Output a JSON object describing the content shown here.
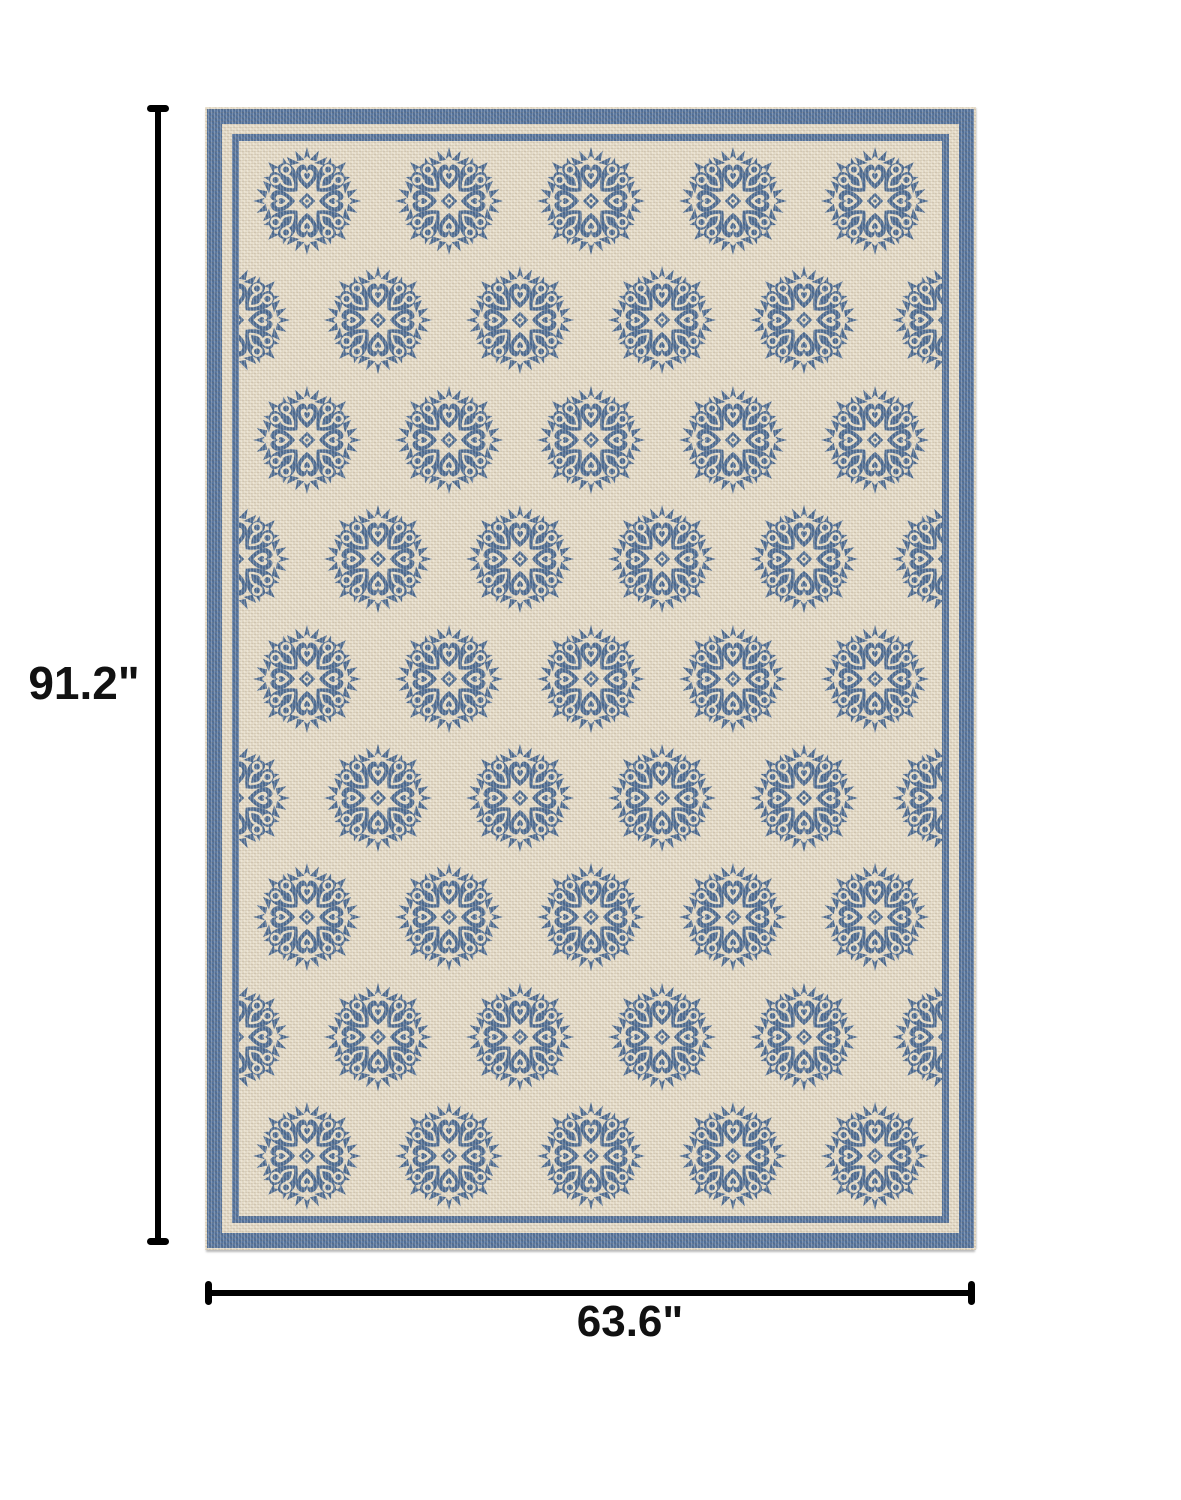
{
  "annotations": {
    "height_label": "91.2\"",
    "width_label": "63.6\"",
    "line_color": "#000000"
  },
  "rug": {
    "description": "cream and blue floral medallion area rug",
    "pattern": {
      "rows": 9,
      "medallions_full_row": 5,
      "medallions_offset_row": 6,
      "motif": "floral-damask-medallion",
      "medallion_width": 112,
      "medallion_height": 110,
      "column_pitch": 142
    },
    "colors": {
      "field": "#e7ddc9",
      "border_band": "#53729c",
      "motif": "#4c6b93",
      "motif_detail": "#e9e0cc"
    }
  }
}
